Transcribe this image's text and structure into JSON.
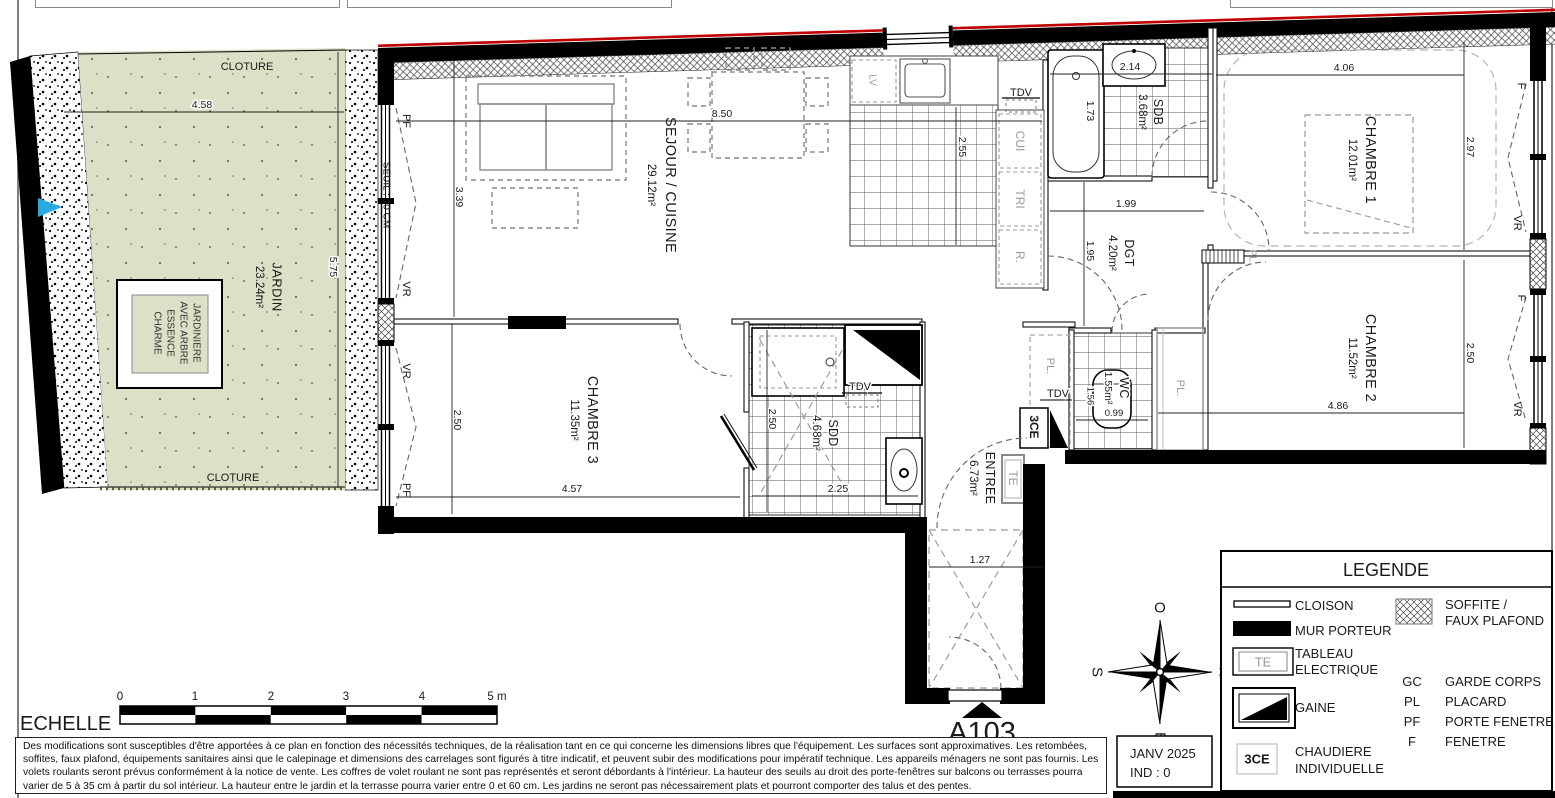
{
  "title": "A103",
  "titleblock": {
    "date": "JANV 2025",
    "index": "IND : 0"
  },
  "legend": {
    "title": "LEGENDE",
    "items": {
      "cloison": "CLOISON",
      "mur_porteur": "MUR PORTEUR",
      "tableau_line1": "TABLEAU",
      "tableau_line2": "ELECTRIQUE",
      "tableau_symbol": "TE",
      "gaine": "GAINE",
      "chaudiere_line1": "CHAUDIERE",
      "chaudiere_line2": "INDIVIDUELLE",
      "chaudiere_symbol": "3CE",
      "soffite_line1": "SOFFITE /",
      "soffite_line2": "FAUX PLAFOND"
    },
    "abbreviations": [
      {
        "abbr": "GC",
        "label": "GARDE CORPS"
      },
      {
        "abbr": "PL",
        "label": "PLACARD"
      },
      {
        "abbr": "PF",
        "label": "PORTE FENETRE"
      },
      {
        "abbr": "F",
        "label": "FENETRE"
      }
    ]
  },
  "rooms": {
    "jardin": {
      "name": "JARDIN",
      "area": "23.24m²"
    },
    "sejour": {
      "name": "SEJOUR / CUISINE",
      "area": "29.12m²"
    },
    "ch1": {
      "name": "CHAMBRE 1",
      "area": "12.01m²"
    },
    "ch2": {
      "name": "CHAMBRE 2",
      "area": "11.52m²"
    },
    "ch3": {
      "name": "CHAMBRE 3",
      "area": "11.35m²"
    },
    "sdb": {
      "name": "SDB",
      "area": "3.68m²"
    },
    "sdd": {
      "name": "SDD",
      "area": "4.68m²"
    },
    "wc": {
      "name": "WC",
      "area": "1.55m²"
    },
    "dgt": {
      "name": "DGT",
      "area": "4.20m²"
    },
    "entree": {
      "name": "ENTREE",
      "area": "6.73m²"
    }
  },
  "dims": {
    "garden_w": "4.58",
    "garden_h": "5.75",
    "sejour_w": "8.50",
    "sejour_h": "3.39",
    "cuisine_h": "2.55",
    "bath": "1.73",
    "sdb_w": "2.14",
    "dgt_w": "1.99",
    "dgt_h": "1.95",
    "ch1_w": "4.06",
    "ch1_h": "2.97",
    "ch2_w": "4.86",
    "ch2_h": "2.50",
    "ch3_w": "4.57",
    "ch3_h": "2.50",
    "sdd_h": "2.50",
    "sdd_w": "2.25",
    "wc_h": "1.56",
    "wc_w": "0.99",
    "hall_w": "1.27"
  },
  "labels": {
    "cloture_top": "CLOTURE",
    "cloture_bottom": "CLOTURE",
    "seuil": "SEUIL : 10 CM",
    "jardiniere_lines": [
      "JARDINIERE",
      "AVEC ARBRE",
      "ESSENCE",
      "CHARME"
    ],
    "tdv": "TDV",
    "cui": "CUI",
    "tri": "TRI",
    "r": "R.",
    "lv": "LV",
    "pl": "PL.",
    "te": "TE",
    "ce": "3CE",
    "pf": "PF",
    "vr": "VR",
    "f": "F"
  },
  "scale": {
    "label": "ECHELLE",
    "ticks": [
      "0",
      "1",
      "2",
      "3",
      "4",
      "5 m"
    ]
  },
  "compass": {
    "top": "O",
    "right": "N",
    "bottom": "E",
    "left": "S"
  },
  "colors": {
    "garden": "#dbe0c6",
    "marker_blue": "#29abe2",
    "wall_red": "#c00000"
  },
  "disclaimer": "Des modifications sont susceptibles d'être apportées à ce plan en fonction des nécessités techniques, de la réalisation tant en ce qui concerne les dimensions libres que l'équipement. Les surfaces sont approximatives. Les retombées, soffites, faux plafond, équipements sanitaires ainsi que le calepinage et dimensions des carrelages sont figurés à titre indicatif, et peuvent subir des modifications pour impératif technique. Les appareils ménagers ne sont pas fournis. Les volets roulants seront prévus conformément à la notice de vente. Les coffres de volet roulant ne sont pas représentés et seront débordants à l'intérieur. La hauteur des seuils au droit des porte-fenêtres sur balcons ou terrasses pourra varier de 5 à 35 cm à partir du sol intérieur. La hauteur entre le jardin et la terrasse pourra varier entre 0 et 60 cm. Les jardins ne seront pas nécessairement plats et pourront comporter des talus et des pentes."
}
